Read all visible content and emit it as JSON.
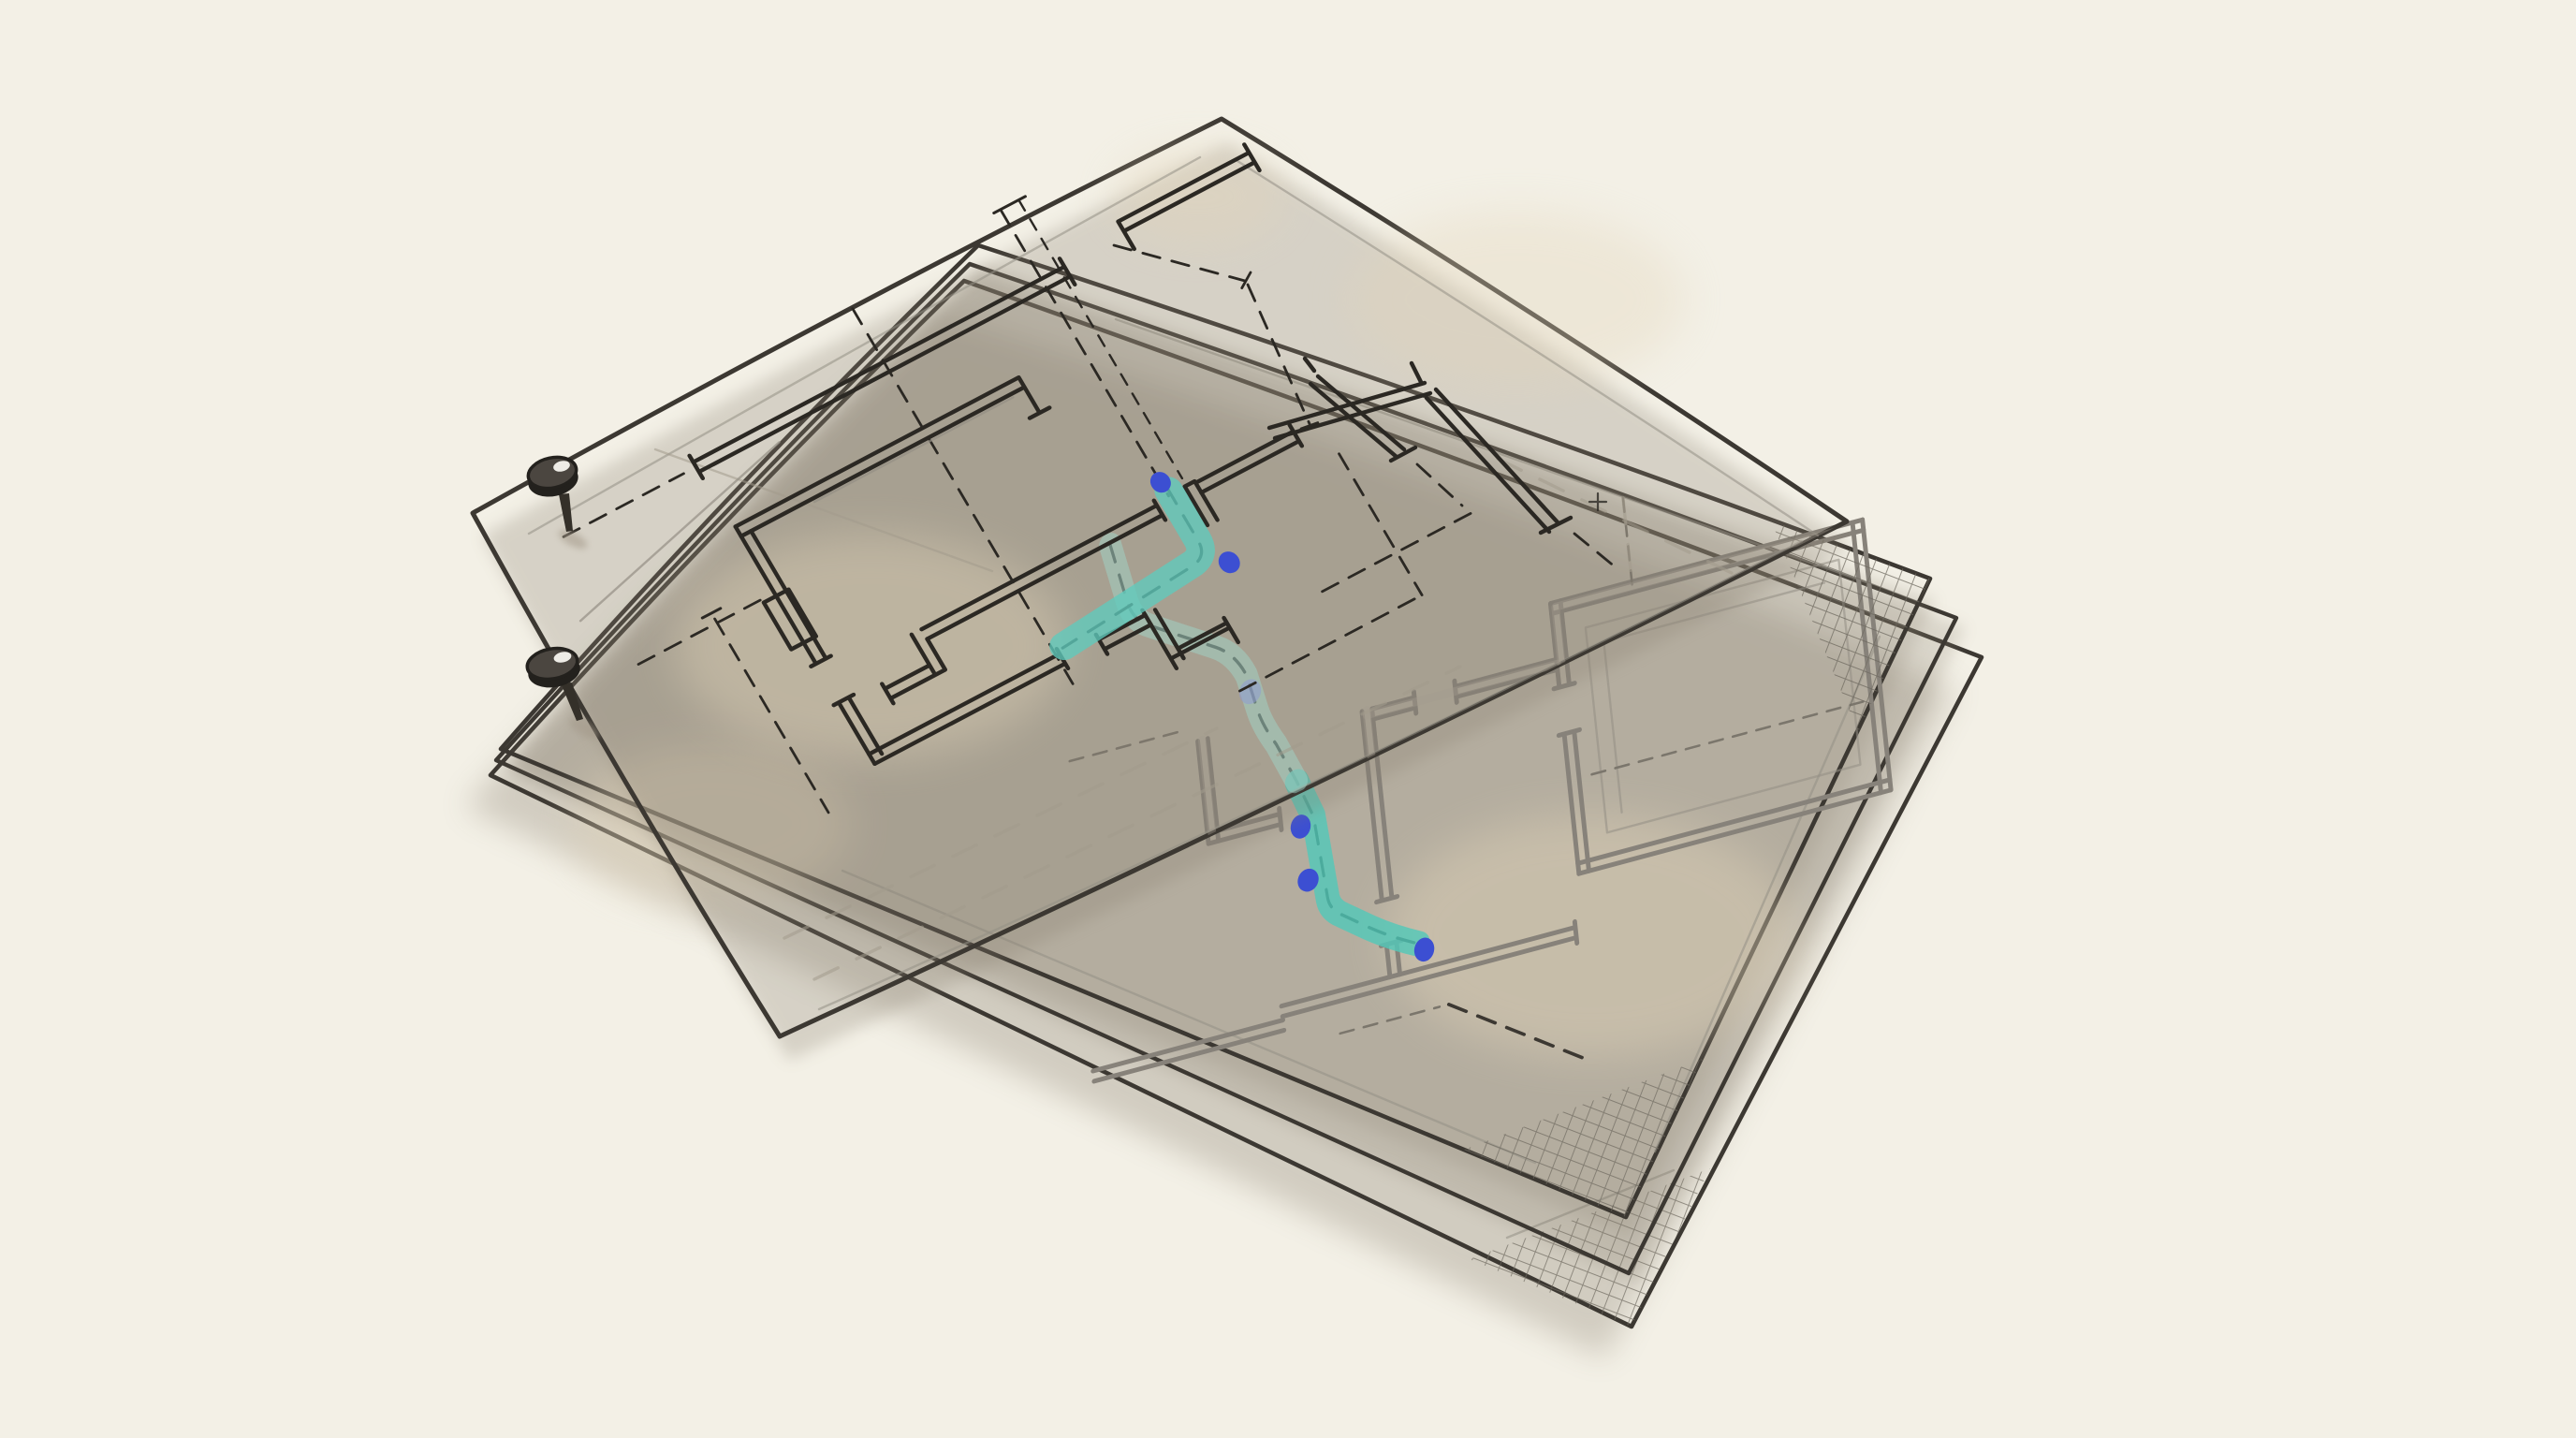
{
  "meta": {
    "title": "Hand-drawn illustration of pinned, stacked architectural floor-plan sketches",
    "style": "ink and watercolor sketch",
    "visible_text": ""
  },
  "colors": {
    "background": "#f3f0e6",
    "paper_top": "#f4eedf",
    "paper_mid": "#f1e9d8",
    "paper_low": "#efe7d5",
    "paper_bottom": "#ece3cf",
    "blotch": "#e3d5ba",
    "edge_ink": "#3c3832",
    "plan_ink": "#2b2823",
    "plan_gray": "#87827a",
    "sketch_gray": "#948f85",
    "ghost": "#a29b8d",
    "dash_gray": "#7b766c",
    "teal_top": "#5fcabc",
    "teal_bottom": "#53c8b8",
    "teal_pale": "#9fd9cf",
    "blue_dot": "#3c4fd2",
    "blue_dot_faded": "#8d97d6",
    "hatch": "#6e695f",
    "shadow": "#857c6c",
    "pin_rim": "#23211d",
    "pin_head": "#4b4640",
    "pin_needle": "#343029",
    "pin_glint": "#f7f5ef",
    "pin_shadow": "#a49a8a"
  },
  "scene": {
    "sheets": [
      {
        "id": "sheet-top",
        "label": "Top tracing-paper sheet with black ink floor plan, dashed construction lines, teal highlighted route and two blue markers"
      },
      {
        "id": "sheet-middle",
        "label": "Middle sheet with gray floor plan, teal route, three blue markers and crosshatched corners"
      },
      {
        "id": "sheet-under",
        "label": "Third sheet of the stack, edges visible only"
      },
      {
        "id": "sheet-bottom",
        "label": "Bottom sheet with crosshatched corner"
      }
    ],
    "pins": [
      {
        "id": "push-pin-1",
        "label": "Push pin at upper left edge of the stack"
      },
      {
        "id": "push-pin-2",
        "label": "Push pin at left corner of the lower sheets"
      }
    ],
    "routes": [
      {
        "id": "route-top",
        "label": "Teal highlighter route over dashed path on top sheet: short drop then long run to the lower left"
      },
      {
        "id": "route-bottom",
        "label": "Teal highlighter route on middle sheet: descends from under the top sheet, zigzags down to a rounded end"
      }
    ],
    "markers": {
      "top_sheet_dots": 2,
      "middle_sheet_dots": 3,
      "faded_dots_under_paper": 1
    }
  }
}
